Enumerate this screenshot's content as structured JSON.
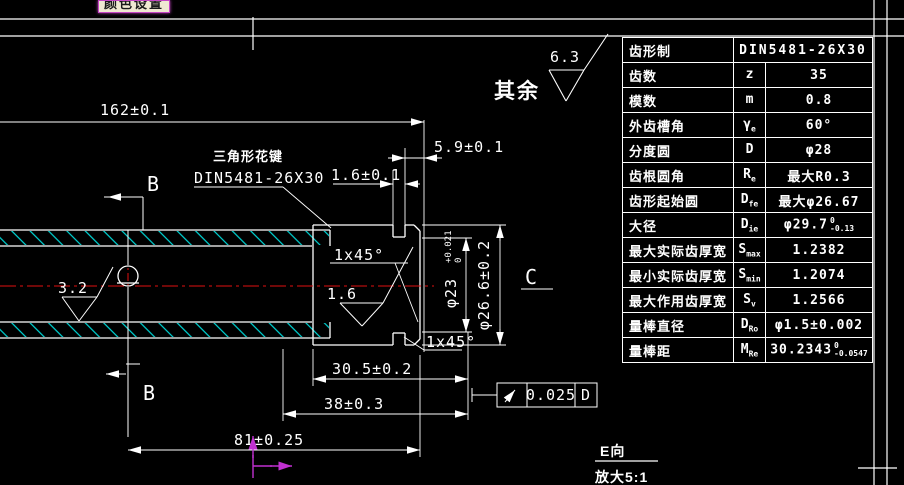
{
  "tooltip": {
    "text": "颜色设置"
  },
  "general_roughness": {
    "prefix": "其余",
    "value": "6.3"
  },
  "drawing": {
    "dims": {
      "len162": "162±0.1",
      "d59": "5.9±0.1",
      "d16": "1.6±0.1",
      "d305": "30.5±0.2",
      "d38": "38±0.3",
      "d81": "81±0.25",
      "dia23": {
        "main": "φ23",
        "tol_top": "+0.021",
        "tol_bottom": "0"
      },
      "dia266": "φ26.6±0.2"
    },
    "roughness": {
      "r32": "3.2",
      "r16": "1.6"
    },
    "spline_callout": {
      "line1": "三角形花键",
      "line2": "DIN5481-26X30"
    },
    "section_label_top": "B",
    "section_label_bottom": "B",
    "detail_label": "C",
    "chamfer_top": "1x45°",
    "chamfer_bottom": "1x45°",
    "gdt": {
      "symbol_name": "circular-runout",
      "tolerance": "0.025",
      "datum": "D"
    },
    "detail_view": {
      "title": "E向",
      "scale": "放大5:1"
    }
  },
  "table": {
    "rows": [
      {
        "label": "齿形制",
        "symbol": "",
        "symbol_sub": "",
        "value": "DIN5481-26X30"
      },
      {
        "label": "齿数",
        "symbol": "z",
        "symbol_sub": "",
        "value": "35"
      },
      {
        "label": "模数",
        "symbol": "m",
        "symbol_sub": "",
        "value": "0.8"
      },
      {
        "label": "外齿槽角",
        "symbol": "γ",
        "symbol_sub": "e",
        "value": "60°"
      },
      {
        "label": "分度圆",
        "symbol": "D",
        "symbol_sub": "",
        "value": "φ28"
      },
      {
        "label": "齿根圆角",
        "symbol": "R",
        "symbol_sub": "e",
        "value": "最大R0.3"
      },
      {
        "label": "齿形起始圆",
        "symbol": "D",
        "symbol_sub": "fe",
        "value": "最大φ26.67"
      },
      {
        "label": "大径",
        "symbol": "D",
        "symbol_sub": "ie",
        "value": "φ29.7",
        "tol_top": "0",
        "tol_bottom": "-0.13"
      },
      {
        "label": "最大实际齿厚宽",
        "symbol": "S",
        "symbol_sub": "max",
        "value": "1.2382"
      },
      {
        "label": "最小实际齿厚宽",
        "symbol": "S",
        "symbol_sub": "min",
        "value": "1.2074"
      },
      {
        "label": "最大作用齿厚宽",
        "symbol": "S",
        "symbol_sub": "v",
        "value": "1.2566"
      },
      {
        "label": "量棒直径",
        "symbol": "D",
        "symbol_sub": "Ro",
        "value": "φ1.5±0.002"
      },
      {
        "label": "量棒距",
        "symbol": "M",
        "symbol_sub": "Re",
        "value": "30.2343",
        "tol_top": "0",
        "tol_bottom": "-0.0547"
      }
    ]
  },
  "colors": {
    "background": "#000000",
    "line": "#ffffff",
    "hatch": "#00d8d8",
    "centerline": "#e01010",
    "ucs_icon": "#c030d0",
    "tooltip_bg": "#efe9d2",
    "tooltip_border": "#c445c4"
  }
}
